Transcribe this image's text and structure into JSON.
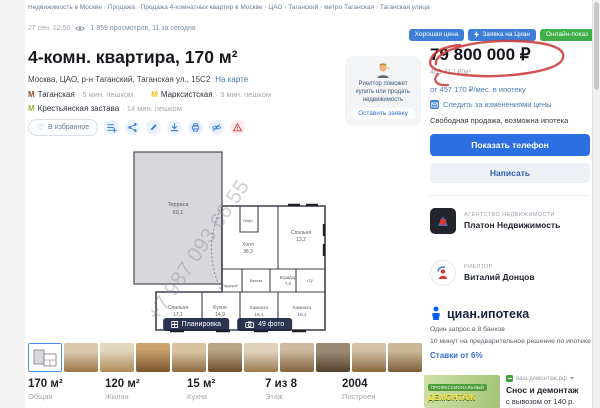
{
  "page": {
    "breadcrumb": [
      "Недвижимость в Москве",
      "Продажа",
      "Продажа 4-комнатных квартир в Москве",
      "ЦАО",
      "Таганский",
      "метро Таганская",
      "Таганская улица"
    ],
    "posted": "27 сен, 12:50",
    "views": "1 859 просмотров, 11 за сегодня"
  },
  "badges": {
    "good_price": "Хорошая цена",
    "cian_request": "Заявка на Циан",
    "online_show": "Онлайн-показ"
  },
  "listing": {
    "title": "4-комн. квартира, 170 м²",
    "address": "Москва, ЦАО, р-н Таганский, Таганская ул., 15С2",
    "map_link": "На карте",
    "metro": [
      {
        "name": "Таганская",
        "time": "5 мин. пешком"
      },
      {
        "name": "Марксистская",
        "time": "3 мин. пешком"
      },
      {
        "name": "Крестьянская застава",
        "time": "14 мин. пешком"
      }
    ],
    "favorite_label": "В избранное"
  },
  "plan": {
    "watermark": "+7 987 093 66 55",
    "planirovka_label": "Планировка",
    "photos_label": "49 фото",
    "rooms": {
      "terrace": {
        "name": "Терраса",
        "area": "69,1"
      },
      "hall": {
        "name": "Холл",
        "area": "38,3"
      },
      "lift": {
        "name": "Лифт"
      },
      "bedroom1": {
        "name": "Спальня",
        "area": "13,2"
      },
      "corridor": {
        "name": "Коридор",
        "area": "7,6"
      },
      "wc": {
        "name": "с/у"
      },
      "bath": {
        "name": "Ванная"
      },
      "wardrobe": {
        "name": "Гардероб"
      },
      "bedroom2": {
        "name": "Спальня",
        "area": "17,1"
      },
      "kitchen": {
        "name": "Кухня",
        "area": "14,9"
      },
      "room1": {
        "name": "Комната",
        "area": "15,1"
      },
      "room2": {
        "name": "Комната",
        "area": "16,1"
      }
    }
  },
  "stats": [
    {
      "value": "170 м²",
      "label": "Общая"
    },
    {
      "value": "120 м²",
      "label": "Жилая"
    },
    {
      "value": "15 м²",
      "label": "Кухня"
    },
    {
      "value": "7 из 8",
      "label": "Этаж"
    },
    {
      "value": "2004",
      "label": "Построен"
    }
  ],
  "price_panel": {
    "price": "79 800 000 ₽",
    "price_per_m2": "469 412 ₽/м²",
    "mortgage_link": "от 457 170 ₽/мес. в ипотеку",
    "track_price": "Следить за изменениями цены",
    "terms": "Свободная продажа, возможна ипотека",
    "show_phone": "Показать телефон",
    "write": "Написать"
  },
  "helper_card": {
    "text": "Риелтор поможет купить или продать недвижимость",
    "button": "Оставить заявку"
  },
  "agency": {
    "type_label": "АГЕНТСТВО НЕДВИЖИМОСТИ",
    "name": "Платон Недвижимость"
  },
  "realtor": {
    "type_label": "РИЕЛТОР",
    "name": "Виталий Донцов"
  },
  "mortgage_widget": {
    "brand": "циан.ипотека",
    "line1": "Один запрос в 8 банков",
    "line2": "10 минут на предварительное решение по ипотеке",
    "rates": "Ставки от 6%"
  },
  "ad": {
    "img_line1": "ПРОФЕССИОНАЛЬНЫЙ",
    "img_line2": "ДЕМОНТАЖ",
    "site": "ваш-демонтаж.рф",
    "title": "Снос и демонтаж",
    "subtitle": "с вывозом от 140 р."
  },
  "colors": {
    "accent_blue": "#2b6fe3",
    "badge_blue": "#3d7fd6",
    "badge_green": "#3fae49",
    "annotation_red": "#c93b3b",
    "metro_taganskaya": "#8a4b25",
    "metro_marksistskaya": "#e8bf16",
    "metro_krestyanskaya": "#94ba2c"
  }
}
